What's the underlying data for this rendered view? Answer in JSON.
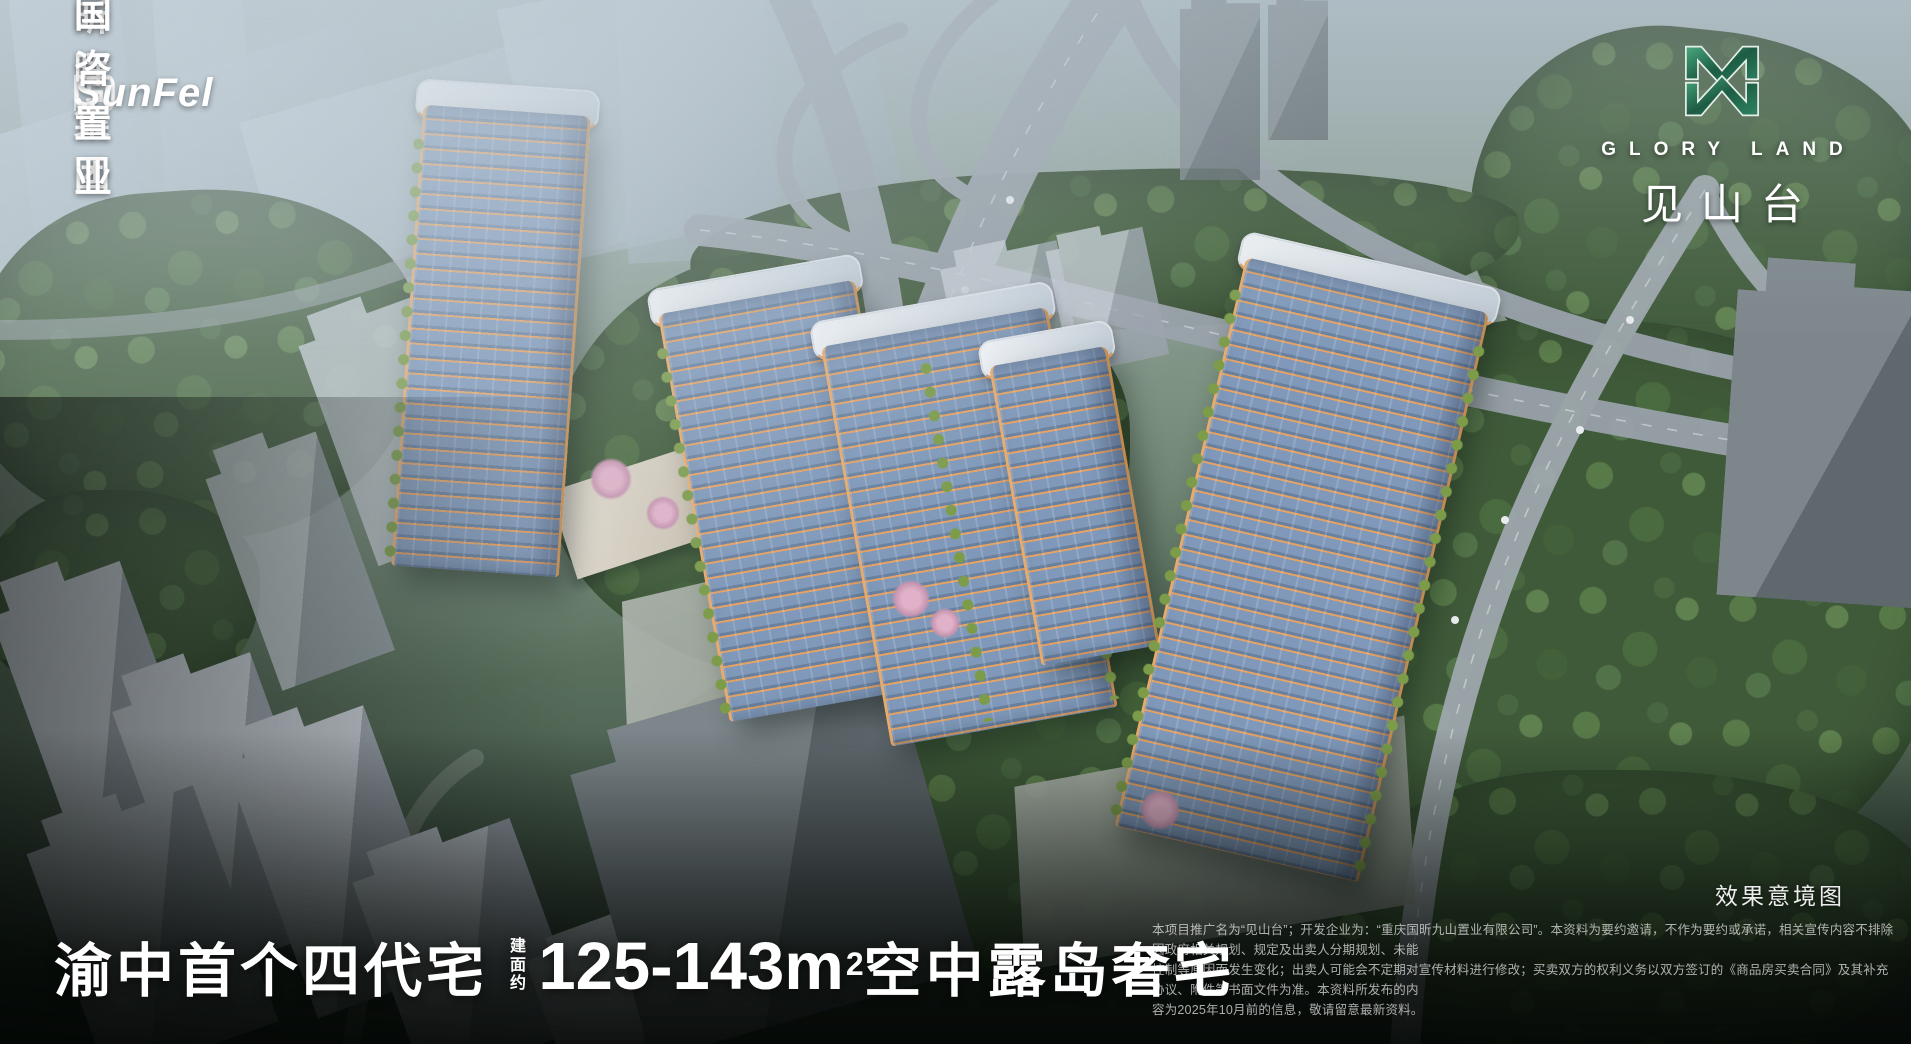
{
  "header": {
    "brand_left": {
      "latin": "SunFel",
      "cn": "昕晖集团",
      "partner": "国咨置业",
      "partner_icon": "guozi-seal-icon"
    },
    "brand_right": {
      "logo_icon": "gloryland-butterfly-m-icon",
      "en": "GLORY LAND",
      "cn": "见山台"
    }
  },
  "headline": {
    "lead": "渝中首个四代宅",
    "area_label": "建面约",
    "area_value": "125-143m",
    "area_sup": "2",
    "tail": "空中露岛奢宅"
  },
  "legal": {
    "caption": "效果意境图",
    "lines": [
      "本项目推广名为“见山台”；开发企业为：“重庆国昕九山置业有限公司”。本资料为要约邀请，不作为要约或承诺，相关宣传内容不排除因政府相关规划、规定及出卖人分期规划、未能",
      "控制等原因而发生变化；出卖人可能会不定期对宣传材料进行修改；买卖双方的权利义务以双方签订的《商品房买卖合同》及其补充协议、附件等书面文件为准。本资料所发布的内",
      "容为2025年10月前的信息，敬请留意最新资料。"
    ]
  },
  "colors": {
    "brand_green": "#2e8463",
    "brand_green_dark": "#1d5c44",
    "accent_orange": "#e3a266",
    "facade_blue": "#8099ba",
    "text_white": "#ffffff"
  }
}
